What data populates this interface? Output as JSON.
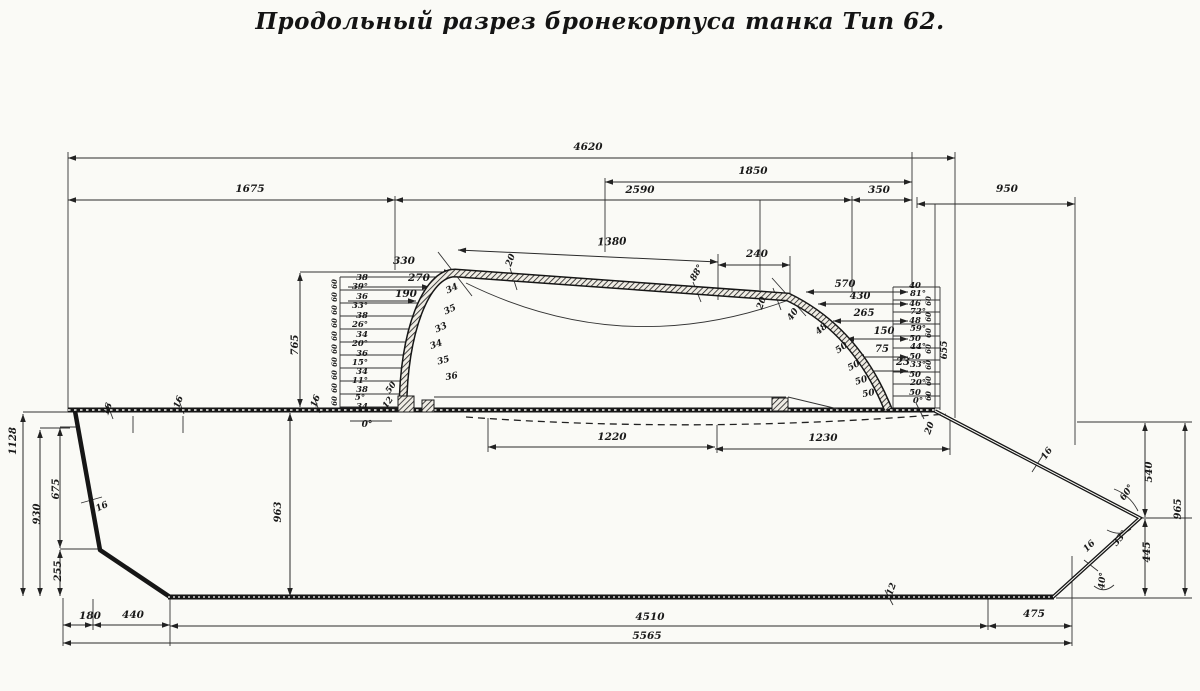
{
  "title": "Продольный разрез бронекорпуса танка Тип 62.",
  "drawing": {
    "paper_color": "#fafaf6",
    "ink_color": "#1b1b1b",
    "labels": [
      {
        "t": "4620",
        "x": 588,
        "y": 150
      },
      {
        "t": "1675",
        "x": 250,
        "y": 192
      },
      {
        "t": "2590",
        "x": 640,
        "y": 193
      },
      {
        "t": "1850",
        "x": 753,
        "y": 174
      },
      {
        "t": "350",
        "x": 879,
        "y": 193
      },
      {
        "t": "950",
        "x": 1007,
        "y": 192
      },
      {
        "t": "1380",
        "x": 612,
        "y": 245,
        "r": -2
      },
      {
        "t": "240",
        "x": 757,
        "y": 257
      },
      {
        "t": "330",
        "x": 404,
        "y": 264
      },
      {
        "t": "270",
        "x": 419,
        "y": 281
      },
      {
        "t": "190",
        "x": 406,
        "y": 297
      },
      {
        "t": "20",
        "x": 513,
        "y": 261,
        "r": -70,
        "fs": 9
      },
      {
        "t": "88°",
        "x": 699,
        "y": 274,
        "r": -60,
        "fs": 9
      },
      {
        "t": "20",
        "x": 764,
        "y": 304,
        "r": -70,
        "fs": 9
      },
      {
        "t": "40",
        "x": 795,
        "y": 316,
        "r": -55,
        "fs": 9
      },
      {
        "t": "34",
        "x": 453,
        "y": 291,
        "r": -25,
        "fs": 9
      },
      {
        "t": "35",
        "x": 451,
        "y": 312,
        "r": -25,
        "fs": 9
      },
      {
        "t": "33",
        "x": 442,
        "y": 330,
        "r": -25,
        "fs": 9
      },
      {
        "t": "34",
        "x": 437,
        "y": 347,
        "r": -20,
        "fs": 9
      },
      {
        "t": "35",
        "x": 444,
        "y": 363,
        "r": -15,
        "fs": 9
      },
      {
        "t": "36",
        "x": 452,
        "y": 379,
        "r": -10,
        "fs": 9
      },
      {
        "t": "38",
        "x": 362,
        "y": 280,
        "fs": 8.5
      },
      {
        "t": "39°",
        "x": 360,
        "y": 289,
        "fs": 8.5
      },
      {
        "t": "36",
        "x": 362,
        "y": 299,
        "fs": 8.5
      },
      {
        "t": "33°",
        "x": 360,
        "y": 308,
        "fs": 8.5
      },
      {
        "t": "38",
        "x": 362,
        "y": 318,
        "fs": 8.5
      },
      {
        "t": "26°",
        "x": 360,
        "y": 327,
        "fs": 8.5
      },
      {
        "t": "34",
        "x": 362,
        "y": 337,
        "fs": 8.5
      },
      {
        "t": "20°",
        "x": 360,
        "y": 346,
        "fs": 8.5
      },
      {
        "t": "36",
        "x": 362,
        "y": 356,
        "fs": 8.5
      },
      {
        "t": "15°",
        "x": 360,
        "y": 365,
        "fs": 8.5
      },
      {
        "t": "34",
        "x": 362,
        "y": 374,
        "fs": 8.5
      },
      {
        "t": "11°",
        "x": 360,
        "y": 383,
        "fs": 8.5
      },
      {
        "t": "38",
        "x": 362,
        "y": 392,
        "fs": 8.5
      },
      {
        "t": "5°",
        "x": 360,
        "y": 400,
        "fs": 8.5
      },
      {
        "t": "34",
        "x": 362,
        "y": 409,
        "fs": 8.5
      },
      {
        "t": "50",
        "x": 393,
        "y": 389,
        "r": -55,
        "fs": 8.5
      },
      {
        "t": "12",
        "x": 390,
        "y": 404,
        "r": -55,
        "fs": 8.5
      },
      {
        "t": "0°",
        "x": 367,
        "y": 427,
        "fs": 9
      },
      {
        "t": "60",
        "x": 337,
        "y": 284,
        "r": -90,
        "fs": 7
      },
      {
        "t": "60",
        "x": 337,
        "y": 297,
        "r": -90,
        "fs": 7
      },
      {
        "t": "60",
        "x": 337,
        "y": 310,
        "r": -90,
        "fs": 7
      },
      {
        "t": "60",
        "x": 337,
        "y": 323,
        "r": -90,
        "fs": 7
      },
      {
        "t": "60",
        "x": 337,
        "y": 336,
        "r": -90,
        "fs": 7
      },
      {
        "t": "60",
        "x": 337,
        "y": 349,
        "r": -90,
        "fs": 7
      },
      {
        "t": "60",
        "x": 337,
        "y": 362,
        "r": -90,
        "fs": 7
      },
      {
        "t": "60",
        "x": 337,
        "y": 375,
        "r": -90,
        "fs": 7
      },
      {
        "t": "60",
        "x": 337,
        "y": 388,
        "r": -90,
        "fs": 7
      },
      {
        "t": "60",
        "x": 337,
        "y": 401,
        "r": -90,
        "fs": 7
      },
      {
        "t": "570",
        "x": 845,
        "y": 287,
        "fs": 10
      },
      {
        "t": "430",
        "x": 860,
        "y": 299,
        "fs": 10
      },
      {
        "t": "265",
        "x": 864,
        "y": 316,
        "fs": 10
      },
      {
        "t": "150",
        "x": 884,
        "y": 334,
        "fs": 10
      },
      {
        "t": "75",
        "x": 882,
        "y": 352,
        "fs": 10
      },
      {
        "t": "23",
        "x": 903,
        "y": 365,
        "fs": 10
      },
      {
        "t": "48",
        "x": 823,
        "y": 331,
        "r": -40,
        "fs": 9
      },
      {
        "t": "50",
        "x": 843,
        "y": 350,
        "r": -35,
        "fs": 9
      },
      {
        "t": "50",
        "x": 855,
        "y": 368,
        "r": -28,
        "fs": 9
      },
      {
        "t": "50",
        "x": 862,
        "y": 383,
        "r": -18,
        "fs": 9
      },
      {
        "t": "50",
        "x": 869,
        "y": 396,
        "r": -12,
        "fs": 9
      },
      {
        "t": "40",
        "x": 915,
        "y": 288,
        "fs": 8.5
      },
      {
        "t": "81°",
        "x": 918,
        "y": 296,
        "fs": 8.5
      },
      {
        "t": "46",
        "x": 915,
        "y": 306,
        "fs": 8.5
      },
      {
        "t": "72°",
        "x": 918,
        "y": 314,
        "fs": 8.5
      },
      {
        "t": "48",
        "x": 915,
        "y": 323,
        "fs": 8.5
      },
      {
        "t": "59°",
        "x": 918,
        "y": 331,
        "fs": 8.5
      },
      {
        "t": "50",
        "x": 915,
        "y": 341,
        "fs": 8.5
      },
      {
        "t": "44°",
        "x": 918,
        "y": 349,
        "fs": 8.5
      },
      {
        "t": "50",
        "x": 915,
        "y": 359,
        "fs": 8.5
      },
      {
        "t": "33°",
        "x": 918,
        "y": 367,
        "fs": 8.5
      },
      {
        "t": "50",
        "x": 915,
        "y": 377,
        "fs": 8.5
      },
      {
        "t": "20°",
        "x": 918,
        "y": 385,
        "fs": 8.5
      },
      {
        "t": "50",
        "x": 915,
        "y": 395,
        "fs": 8.5
      },
      {
        "t": "0°",
        "x": 918,
        "y": 403,
        "fs": 8.5
      },
      {
        "t": "60",
        "x": 931,
        "y": 301,
        "r": -90,
        "fs": 7
      },
      {
        "t": "60",
        "x": 931,
        "y": 317,
        "r": -90,
        "fs": 7
      },
      {
        "t": "60",
        "x": 931,
        "y": 333,
        "r": -90,
        "fs": 7
      },
      {
        "t": "60",
        "x": 931,
        "y": 349,
        "r": -90,
        "fs": 7
      },
      {
        "t": "60",
        "x": 931,
        "y": 365,
        "r": -90,
        "fs": 7
      },
      {
        "t": "60",
        "x": 931,
        "y": 381,
        "r": -90,
        "fs": 7
      },
      {
        "t": "60",
        "x": 931,
        "y": 396,
        "r": -90,
        "fs": 7
      },
      {
        "t": "655",
        "x": 947,
        "y": 350,
        "r": -90,
        "fs": 9
      },
      {
        "t": "20",
        "x": 932,
        "y": 429,
        "r": -70,
        "fs": 9
      },
      {
        "t": "1220",
        "x": 612,
        "y": 440
      },
      {
        "t": "1230",
        "x": 823,
        "y": 441
      },
      {
        "t": "1128",
        "x": 16,
        "y": 441,
        "r": -90,
        "fs": 10
      },
      {
        "t": "765",
        "x": 298,
        "y": 345,
        "r": -90,
        "fs": 10
      },
      {
        "t": "963",
        "x": 281,
        "y": 512,
        "r": -90,
        "fs": 10
      },
      {
        "t": "675",
        "x": 59,
        "y": 489,
        "r": -90,
        "fs": 10
      },
      {
        "t": "930",
        "x": 40,
        "y": 514,
        "r": -90,
        "fs": 10
      },
      {
        "t": "255",
        "x": 61,
        "y": 571,
        "r": -90,
        "fs": 10
      },
      {
        "t": "16",
        "x": 110,
        "y": 410,
        "r": -70,
        "fs": 9
      },
      {
        "t": "16",
        "x": 181,
        "y": 403,
        "r": -70,
        "fs": 9
      },
      {
        "t": "16",
        "x": 318,
        "y": 402,
        "r": -70,
        "fs": 9
      },
      {
        "t": "16",
        "x": 103,
        "y": 509,
        "r": -25,
        "fs": 9
      },
      {
        "t": "16",
        "x": 1049,
        "y": 455,
        "r": -55,
        "fs": 9
      },
      {
        "t": "60°",
        "x": 1129,
        "y": 494,
        "r": -55,
        "fs": 9
      },
      {
        "t": "33°",
        "x": 1122,
        "y": 540,
        "r": -50,
        "fs": 9
      },
      {
        "t": "16",
        "x": 1091,
        "y": 548,
        "r": -45,
        "fs": 9
      },
      {
        "t": "40°",
        "x": 1105,
        "y": 581,
        "r": -85,
        "fs": 9
      },
      {
        "t": "540",
        "x": 1152,
        "y": 472,
        "r": -90,
        "fs": 10
      },
      {
        "t": "965",
        "x": 1181,
        "y": 509,
        "r": -90,
        "fs": 10
      },
      {
        "t": "445",
        "x": 1150,
        "y": 552,
        "r": -90,
        "fs": 10
      },
      {
        "t": "12",
        "x": 894,
        "y": 590,
        "r": -70,
        "fs": 9
      },
      {
        "t": "180",
        "x": 90,
        "y": 619
      },
      {
        "t": "440",
        "x": 133,
        "y": 618
      },
      {
        "t": "4510",
        "x": 650,
        "y": 620
      },
      {
        "t": "475",
        "x": 1034,
        "y": 617
      },
      {
        "t": "5565",
        "x": 647,
        "y": 639
      }
    ]
  }
}
